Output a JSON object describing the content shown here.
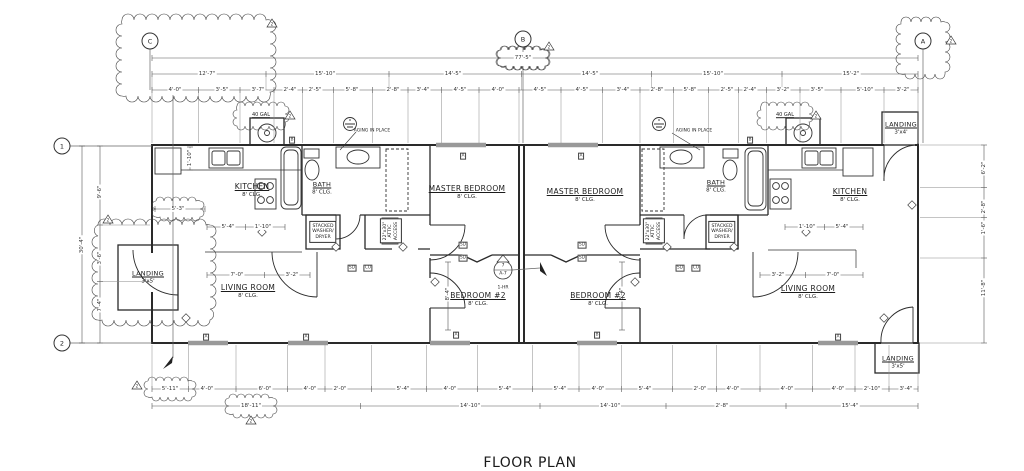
{
  "drawing": {
    "title": "FLOOR PLAN",
    "scale_note": "SCALE:  1/4\"=1'-0\"",
    "line_color": "#2a2a2a",
    "dim_color": "#555555",
    "window_color": "#999999"
  },
  "grid_bubbles": [
    {
      "name": "grid-bubble-c",
      "label": "C",
      "x": 150,
      "y": 41
    },
    {
      "name": "grid-bubble-b",
      "label": "B",
      "x": 523,
      "y": 39
    },
    {
      "name": "grid-bubble-a",
      "label": "A",
      "x": 923,
      "y": 41
    },
    {
      "name": "grid-bubble-1",
      "label": "1",
      "x": 62,
      "y": 146
    },
    {
      "name": "grid-bubble-2",
      "label": "2",
      "x": 62,
      "y": 343
    }
  ],
  "rooms": [
    {
      "name": "room-kitchen-left",
      "label": "KITCHEN",
      "sub": "8' CLG.",
      "x": 252,
      "y": 190
    },
    {
      "name": "room-bath-left",
      "label": "BATH",
      "sub": "8' CLG.",
      "x": 322,
      "y": 188,
      "small": true
    },
    {
      "name": "room-master-bedroom-left",
      "label": "MASTER BEDROOM",
      "sub": "8' CLG.",
      "x": 467,
      "y": 192
    },
    {
      "name": "room-living-room-left",
      "label": "LIVING ROOM",
      "sub": "8' CLG.",
      "x": 248,
      "y": 291
    },
    {
      "name": "room-bedroom2-left",
      "label": "BEDROOM #2",
      "sub": "8' CLG.",
      "x": 478,
      "y": 299
    },
    {
      "name": "room-master-bedroom-right",
      "label": "MASTER BEDROOM",
      "sub": "8' CLG.",
      "x": 585,
      "y": 195
    },
    {
      "name": "room-bath-right",
      "label": "BATH",
      "sub": "8' CLG.",
      "x": 716,
      "y": 186,
      "small": true
    },
    {
      "name": "room-kitchen-right",
      "label": "KITCHEN",
      "sub": "8' CLG.",
      "x": 850,
      "y": 195
    },
    {
      "name": "room-bedroom2-right",
      "label": "BEDROOM #2",
      "sub": "8' CLG.",
      "x": 598,
      "y": 299
    },
    {
      "name": "room-living-room-right",
      "label": "LIVING ROOM",
      "sub": "8' CLG.",
      "x": 808,
      "y": 292
    },
    {
      "name": "room-landing-left",
      "label": "LANDING",
      "sub": "3'x5'",
      "x": 148,
      "y": 277,
      "small": true
    },
    {
      "name": "room-landing-top-right",
      "label": "LANDING",
      "sub": "3'x4'",
      "x": 901,
      "y": 128,
      "small": true
    },
    {
      "name": "room-landing-bottom-right",
      "label": "LANDING",
      "sub": "3'x5'",
      "x": 898,
      "y": 362,
      "small": true
    }
  ],
  "annotations": [
    {
      "name": "note-40gal-left",
      "t": "40 GAL",
      "x": 261,
      "y": 116,
      "cls": "xs u"
    },
    {
      "name": "note-40gal-right",
      "t": "40 GAL",
      "x": 785,
      "y": 116,
      "cls": "xs u"
    },
    {
      "name": "note-aging-in-place-left",
      "t": "AGING IN PLACE",
      "x": 372,
      "y": 131,
      "cls": "tiny"
    },
    {
      "name": "note-aging-in-place-right",
      "t": "AGING IN PLACE",
      "x": 694,
      "y": 131,
      "cls": "tiny"
    },
    {
      "name": "note-1hr-firewall",
      "t": "1-HR",
      "x": 503,
      "y": 288,
      "cls": "tiny"
    }
  ],
  "note_boxes": [
    {
      "name": "note-washer-dryer-left",
      "t": "STACKED\nWASHER/\nDRYER",
      "x": 323,
      "y": 232,
      "rot": 0
    },
    {
      "name": "note-washer-dryer-right",
      "t": "STACKED\nWASHER/\nDRYER",
      "x": 722,
      "y": 232,
      "rot": 0
    },
    {
      "name": "note-attic-access-left",
      "t": "22\"x30\"\nATTIC\nACCESS",
      "x": 391,
      "y": 231,
      "rot": -90
    },
    {
      "name": "note-attic-access-right",
      "t": "22\"x30\"\nATTIC\nACCESS",
      "x": 654,
      "y": 231,
      "rot": -90
    }
  ],
  "detail_marker": {
    "name": "wall-section-marker",
    "top": "7",
    "bottom": "A-7",
    "x": 503,
    "y": 270
  },
  "rev_triangles": [
    {
      "label": "2",
      "x": 272,
      "y": 24
    },
    {
      "label": "2",
      "x": 290,
      "y": 116
    },
    {
      "label": "2",
      "x": 549,
      "y": 47
    },
    {
      "label": "2",
      "x": 951,
      "y": 41
    },
    {
      "label": "2",
      "x": 816,
      "y": 116
    },
    {
      "label": "2",
      "x": 108,
      "y": 220
    },
    {
      "label": "2",
      "x": 137,
      "y": 386
    },
    {
      "label": "2",
      "x": 251,
      "y": 421
    }
  ],
  "window_tags": [
    {
      "t": "B",
      "x": 292,
      "y": 140
    },
    {
      "t": "A",
      "x": 463,
      "y": 156
    },
    {
      "t": "A",
      "x": 581,
      "y": 156
    },
    {
      "t": "B",
      "x": 750,
      "y": 140
    },
    {
      "t": "A",
      "x": 206,
      "y": 337
    },
    {
      "t": "A",
      "x": 306,
      "y": 337
    },
    {
      "t": "A",
      "x": 456,
      "y": 335
    },
    {
      "t": "B",
      "x": 597,
      "y": 335
    },
    {
      "t": "A",
      "x": 838,
      "y": 337
    }
  ],
  "detector_tags": [
    {
      "t": "SD",
      "x": 463,
      "y": 245
    },
    {
      "t": "SD",
      "x": 463,
      "y": 258
    },
    {
      "t": "SD",
      "x": 352,
      "y": 268
    },
    {
      "t": "CO",
      "x": 368,
      "y": 268
    },
    {
      "t": "SD",
      "x": 582,
      "y": 245
    },
    {
      "t": "SD",
      "x": 582,
      "y": 258
    },
    {
      "t": "SD",
      "x": 680,
      "y": 268
    },
    {
      "t": "CO",
      "x": 696,
      "y": 268
    }
  ],
  "dimensions": {
    "h_rows": [
      {
        "y": 58,
        "x1": 152,
        "x2": 918,
        "ext": 0,
        "labels": [
          {
            "t": "77'-5\"",
            "x": 523,
            "c": true
          }
        ]
      },
      {
        "y": 74,
        "x1": 152,
        "x2": 918,
        "ext": 16,
        "labels": [
          {
            "t": "12'-7\"",
            "x": 207
          },
          {
            "t": "15'-10\"",
            "x": 325
          },
          {
            "t": "14'-5\"",
            "x": 453
          },
          {
            "t": "14'-5\"",
            "x": 590
          },
          {
            "t": "15'-10\"",
            "x": 713
          },
          {
            "t": "15'-2\"",
            "x": 851
          }
        ]
      },
      {
        "y": 90,
        "x1": 152,
        "x2": 918,
        "ext": 53,
        "labels": [
          {
            "t": "4'-0\"",
            "x": 175
          },
          {
            "t": "3'-5\"",
            "x": 222
          },
          {
            "t": "3'-7\"",
            "x": 258
          },
          {
            "t": "2'-4\"",
            "x": 290
          },
          {
            "t": "2'-5\"",
            "x": 315
          },
          {
            "t": "5'-8\"",
            "x": 352
          },
          {
            "t": "2'-8\"",
            "x": 393
          },
          {
            "t": "3'-4\"",
            "x": 423
          },
          {
            "t": "4'-5\"",
            "x": 460
          },
          {
            "t": "4'-0\"",
            "x": 498
          },
          {
            "t": "4'-5\"",
            "x": 540
          },
          {
            "t": "4'-5\"",
            "x": 582
          },
          {
            "t": "3'-4\"",
            "x": 623
          },
          {
            "t": "2'-8\"",
            "x": 657
          },
          {
            "t": "5'-8\"",
            "x": 690
          },
          {
            "t": "2'-5\"",
            "x": 727
          },
          {
            "t": "2'-4\"",
            "x": 750
          },
          {
            "t": "3'-2\"",
            "x": 783
          },
          {
            "t": "3'-5\"",
            "x": 817
          },
          {
            "t": "5'-10\"",
            "x": 865
          },
          {
            "t": "3'-2\"",
            "x": 903
          }
        ]
      },
      {
        "y": 389,
        "x1": 152,
        "x2": 918,
        "ext": -44,
        "labels": [
          {
            "t": "5'-11\"",
            "x": 170,
            "c": true
          },
          {
            "t": "4'-0\"",
            "x": 207
          },
          {
            "t": "6'-0\"",
            "x": 265
          },
          {
            "t": "4'-0\"",
            "x": 310
          },
          {
            "t": "2'-0\"",
            "x": 340
          },
          {
            "t": "5'-4\"",
            "x": 403
          },
          {
            "t": "4'-0\"",
            "x": 450
          },
          {
            "t": "5'-4\"",
            "x": 505
          },
          {
            "t": "5'-4\"",
            "x": 560
          },
          {
            "t": "4'-0\"",
            "x": 598
          },
          {
            "t": "5'-4\"",
            "x": 645
          },
          {
            "t": "2'-0\"",
            "x": 700
          },
          {
            "t": "4'-0\"",
            "x": 733
          },
          {
            "t": "4'-0\"",
            "x": 787
          },
          {
            "t": "4'-0\"",
            "x": 838
          },
          {
            "t": "2'-10\"",
            "x": 872
          },
          {
            "t": "3'-4\"",
            "x": 906
          }
        ]
      },
      {
        "y": 406,
        "x1": 152,
        "x2": 918,
        "ext": 0,
        "labels": [
          {
            "t": "18'-11\"",
            "x": 251,
            "c": true
          },
          {
            "t": "14'-10\"",
            "x": 470
          },
          {
            "t": "14'-10\"",
            "x": 610
          },
          {
            "t": "2'-8\"",
            "x": 722
          },
          {
            "t": "15'-4\"",
            "x": 850
          }
        ]
      },
      {
        "y": 227,
        "x1": 207,
        "x2": 285,
        "ext": 0,
        "labels": [
          {
            "t": "5'-4\"",
            "x": 228
          },
          {
            "t": "1'-10\"",
            "x": 263
          }
        ]
      },
      {
        "y": 275,
        "x1": 207,
        "x2": 310,
        "ext": 0,
        "labels": [
          {
            "t": "7'-0\"",
            "x": 237
          },
          {
            "t": "3'-2\"",
            "x": 292
          }
        ]
      },
      {
        "y": 227,
        "x1": 785,
        "x2": 863,
        "ext": 0,
        "labels": [
          {
            "t": "1'-10\"",
            "x": 807
          },
          {
            "t": "5'-4\"",
            "x": 842
          }
        ]
      },
      {
        "y": 275,
        "x1": 760,
        "x2": 863,
        "ext": 0,
        "labels": [
          {
            "t": "3'-2\"",
            "x": 778
          },
          {
            "t": "7'-0\"",
            "x": 833
          }
        ]
      },
      {
        "y": 209,
        "x1": 155,
        "x2": 205,
        "ext": 0,
        "labels": [
          {
            "t": "5'-3\"",
            "x": 178,
            "c": true
          }
        ]
      }
    ],
    "v_rows": [
      {
        "x": 82,
        "y1": 146,
        "y2": 343,
        "ext": 0,
        "labels": [
          {
            "t": "30'-4\"",
            "y": 245
          }
        ]
      },
      {
        "x": 100,
        "y1": 146,
        "y2": 343,
        "ext": 50,
        "labels": [
          {
            "t": "9'-6\"",
            "y": 192
          },
          {
            "t": "3'-6\"",
            "y": 258
          },
          {
            "t": "7'-4\"",
            "y": 305
          }
        ]
      },
      {
        "x": 984,
        "y1": 145,
        "y2": 343,
        "ext": -64,
        "labels": [
          {
            "t": "6'-2\"",
            "y": 168
          },
          {
            "t": "2'-8\"",
            "y": 207
          },
          {
            "t": "1'-6\"",
            "y": 228
          },
          {
            "t": "11'-8\"",
            "y": 288
          }
        ]
      },
      {
        "x": 448,
        "y1": 262,
        "y2": 330,
        "ext": 0,
        "labels": [
          {
            "t": "8'-4\"",
            "y": 294
          }
        ]
      },
      {
        "x": 622,
        "y1": 262,
        "y2": 330,
        "ext": 0,
        "labels": [
          {
            "t": "8'-4\"",
            "y": 294
          }
        ]
      },
      {
        "x": 190,
        "y1": 147,
        "y2": 170,
        "ext": 0,
        "labels": [
          {
            "t": "1'-10\"",
            "y": 158
          }
        ]
      }
    ]
  }
}
